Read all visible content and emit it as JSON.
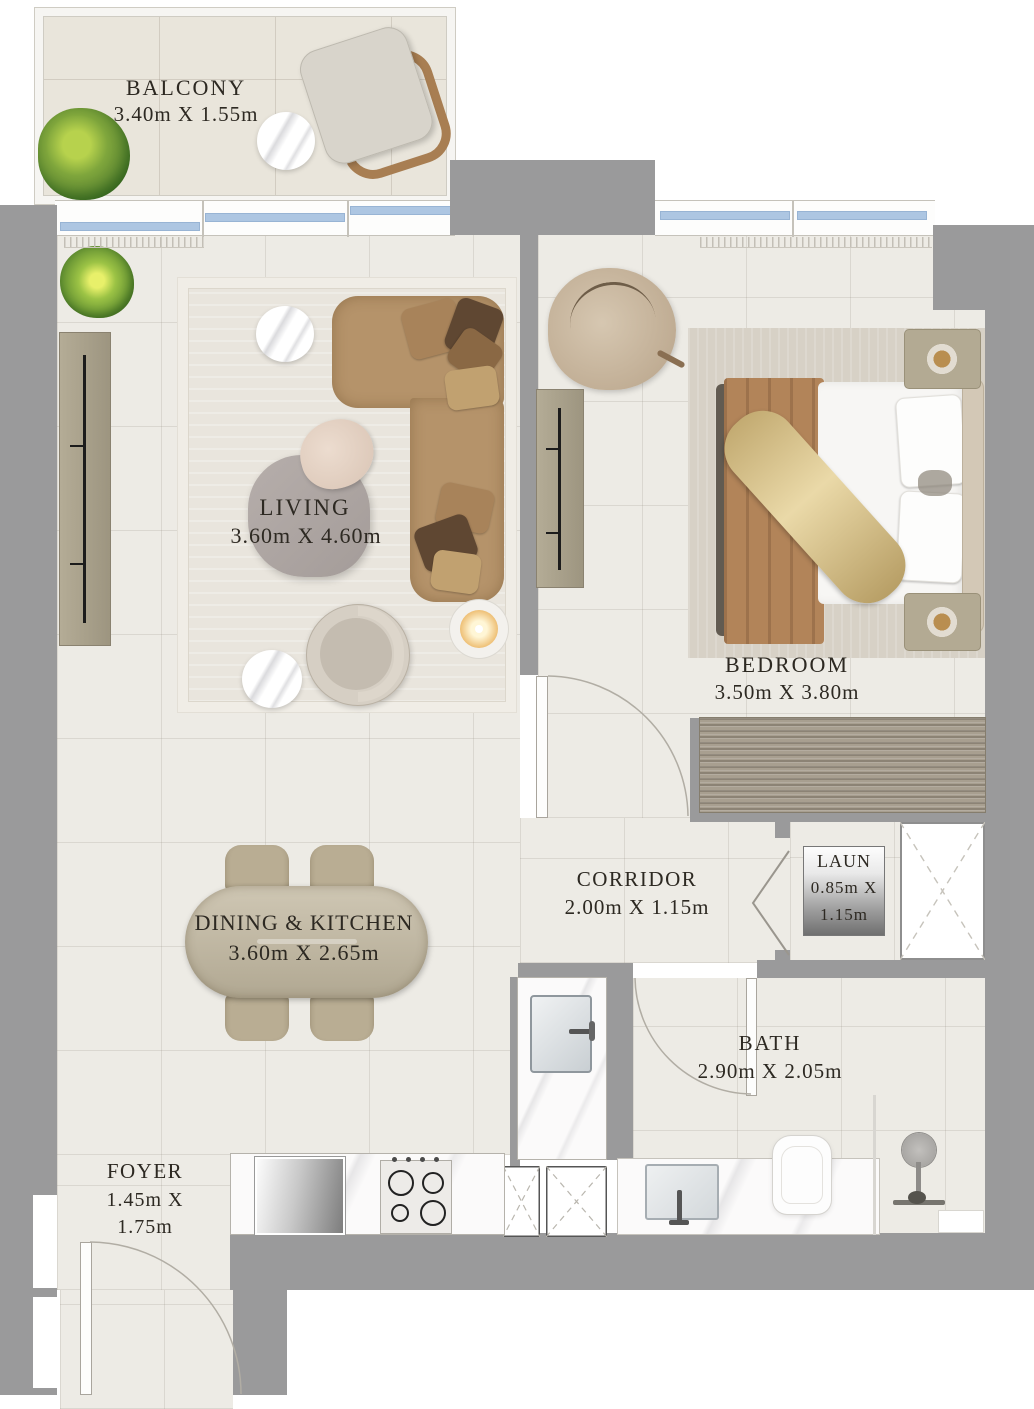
{
  "rooms": {
    "balcony": {
      "name": "BALCONY",
      "dims": "3.40m X 1.55m"
    },
    "living": {
      "name": "LIVING",
      "dims": "3.60m X 4.60m"
    },
    "bedroom": {
      "name": "BEDROOM",
      "dims": "3.50m X 3.80m"
    },
    "corridor": {
      "name": "CORRIDOR",
      "dims": "2.00m X 1.15m"
    },
    "laundry": {
      "name": "LAUN",
      "dims_line1": "0.85m X",
      "dims_line2": "1.15m"
    },
    "dining_kitchen": {
      "name": "DINING & KITCHEN",
      "dims": "3.60m X 2.65m"
    },
    "bath": {
      "name": "BATH",
      "dims": "2.90m X 2.05m"
    },
    "foyer": {
      "name": "FOYER",
      "dims_line1": "1.45m X",
      "dims_line2": "1.75m"
    }
  },
  "colors": {
    "wall": "#9a9a9b",
    "floor": "#edebe5",
    "balcony-floor": "#e9e5db",
    "glass": "#adc6e2",
    "text": "#2d2922",
    "sofa": "#b5936a",
    "rug": "#d7d1c6",
    "closet-wood": "#a89f90",
    "bed-blanket": "#b28459",
    "throw-gold": "#cdb67e",
    "marble": "#fbfafa"
  }
}
